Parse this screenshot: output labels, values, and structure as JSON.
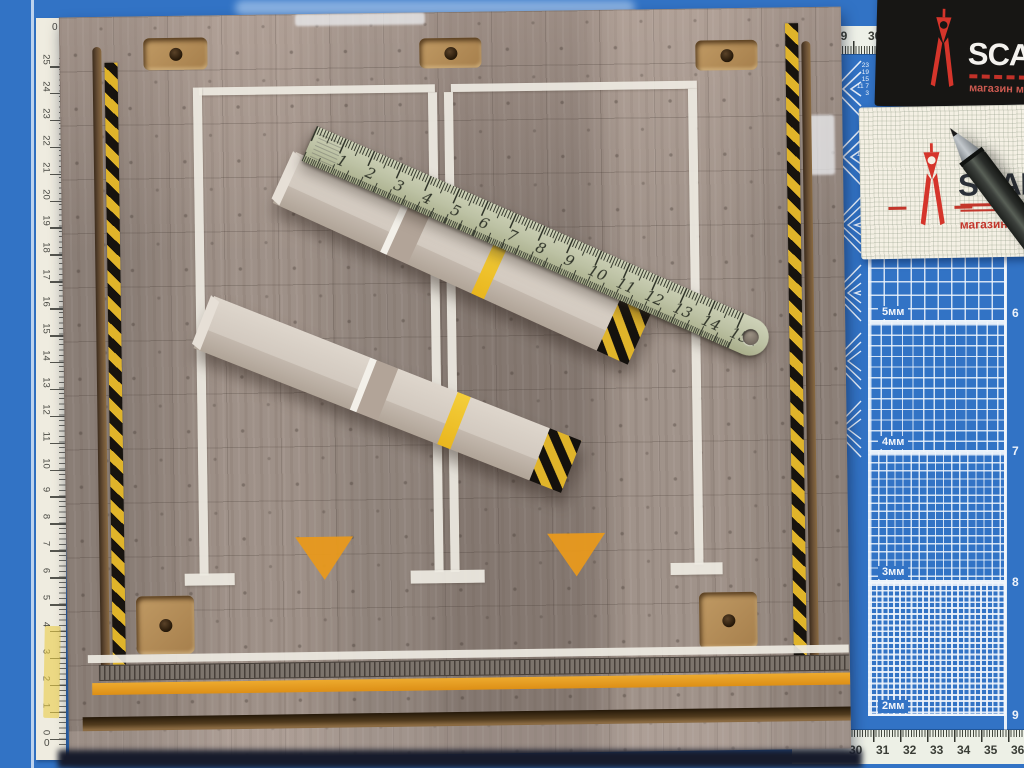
{
  "steel_ruler": {
    "numbers": [
      "1",
      "2",
      "3",
      "4",
      "5",
      "6",
      "7",
      "8",
      "9",
      "10",
      "11",
      "12",
      "13",
      "14",
      "15"
    ],
    "unit": "cm"
  },
  "paper_ruler": {
    "top_zero": "0",
    "bottom_zero": "0",
    "numbers": [
      "25",
      "24",
      "23",
      "22",
      "21",
      "20",
      "19",
      "18",
      "17",
      "16",
      "15",
      "14",
      "13",
      "12",
      "11",
      "10",
      "9",
      "8",
      "7",
      "6",
      "5",
      "4",
      "3",
      "2",
      "1",
      "0"
    ]
  },
  "cutting_mat": {
    "top_numbers": [
      "29",
      "30"
    ],
    "bottom_numbers": [
      "30",
      "31",
      "32",
      "33",
      "34",
      "35",
      "36"
    ],
    "right_numbers": [
      "6",
      "7",
      "8",
      "9"
    ],
    "grid_labels": [
      "5мм",
      "4мм",
      "3мм",
      "2мм"
    ],
    "angle_stack_a": "23 19 15 11 7 3",
    "angle_stack_b": "25 21 17 13 9 5"
  },
  "black_card": {
    "brand": "SCAL",
    "subtitle": "магазин ма"
  },
  "white_card": {
    "brand": "SCAL",
    "subtitle": "магазин"
  },
  "colors": {
    "mat_blue": "#3273c5",
    "accent_red": "#d5352b",
    "hazard_yellow": "#e0b42a",
    "road_orange": "#e8991c",
    "concrete": "#968a82"
  }
}
